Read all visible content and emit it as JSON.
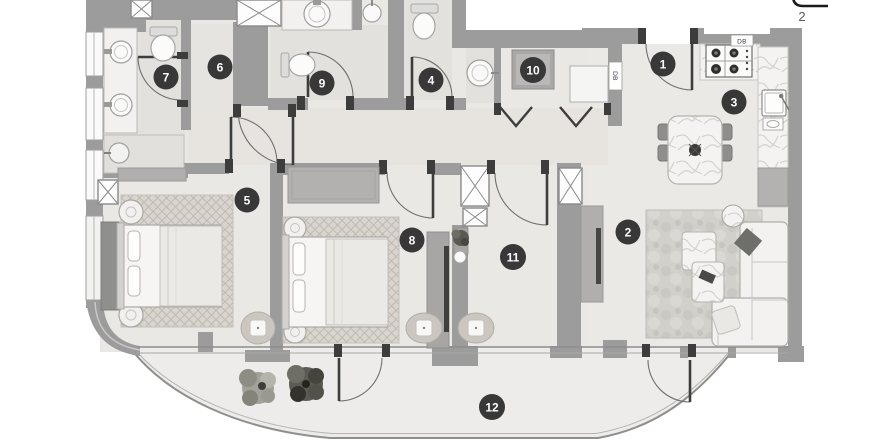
{
  "plan": {
    "title": "apartment-floor-plan",
    "room_badges": [
      {
        "number": "1"
      },
      {
        "number": "2"
      },
      {
        "number": "3"
      },
      {
        "number": "4"
      },
      {
        "number": "5"
      },
      {
        "number": "6"
      },
      {
        "number": "7"
      },
      {
        "number": "8"
      },
      {
        "number": "9"
      },
      {
        "number": "10"
      },
      {
        "number": "11"
      },
      {
        "number": "12"
      }
    ],
    "wall_labels": {
      "kitchen_db": "DB",
      "hall_db": "DB"
    },
    "corner_annotation": "2"
  },
  "colors": {
    "wall": "#9c9c9c",
    "floor": "#e9e8e5",
    "bath_floor": "#e3e1dd",
    "balcony_floor": "#edecea",
    "badge": "#383838",
    "badge_text": "#ffffff",
    "furniture_stroke": "#aeaca8",
    "door_arc": "#6f6f6f",
    "jamb": "#3d3d3d"
  }
}
